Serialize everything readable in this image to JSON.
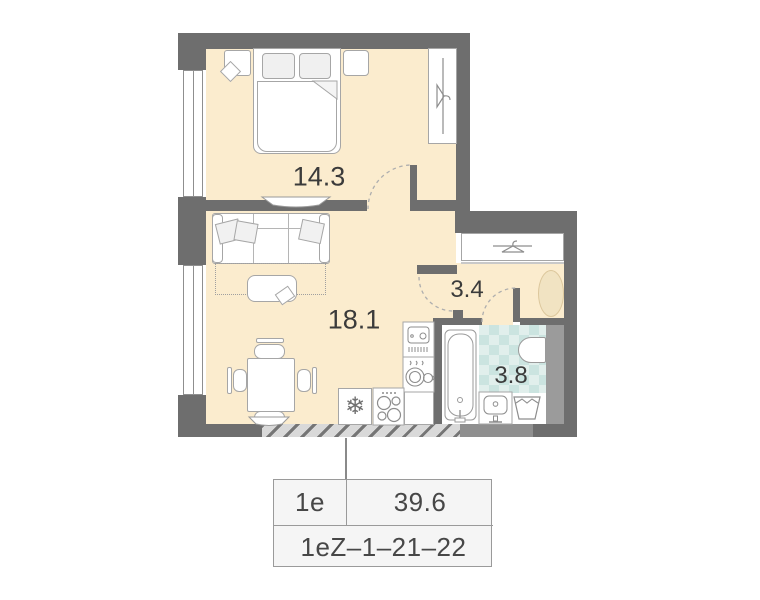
{
  "plan": {
    "rooms": {
      "bedroom": {
        "name": "bedroom",
        "area": "14.3"
      },
      "living": {
        "name": "living-kitchen",
        "area": "18.1"
      },
      "hallway": {
        "name": "hallway",
        "area": "3.4"
      },
      "bathroom": {
        "name": "bathroom",
        "area": "3.8"
      }
    },
    "icons": {
      "fridge_snowflake": "❄"
    }
  },
  "card": {
    "unit_type": "1e",
    "total_area": "39.6",
    "unit_code": "1eZ–1–21–22"
  },
  "colors": {
    "wall": "#6e6e6e",
    "floor": "#fbecce",
    "tile_light": "#e1efec",
    "tile_dark": "#cbe4e0",
    "rug": "#f1e3c2",
    "card_bg": "#f5f5f5"
  }
}
